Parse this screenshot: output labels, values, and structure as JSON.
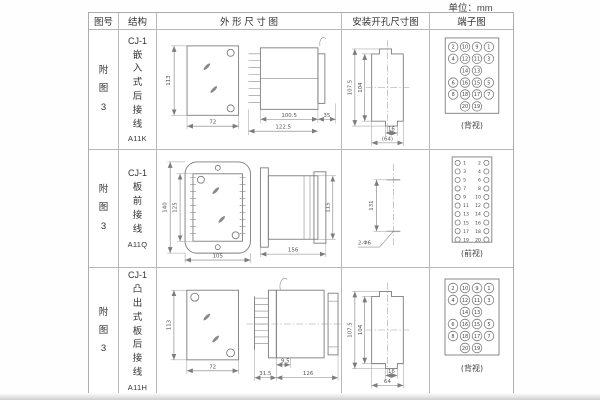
{
  "page": {
    "unit_label": "单位：mm"
  },
  "table": {
    "headers": {
      "fig_no": "图号",
      "structure": "结构",
      "outline": "外 形 尺 寸 图",
      "mounting": "安装开孔尺寸图",
      "terminal": "端子图"
    }
  },
  "rows": [
    {
      "fig_no": "附图3",
      "model": "CJ-1",
      "structure": "嵌入式后接线",
      "code": "A11K",
      "outline": {
        "h": "113",
        "w": "72",
        "d1": "100.5",
        "d2": "122.5",
        "d3": "35"
      },
      "mounting": {
        "outer_h": "107.5",
        "inner_h": "104",
        "slot_w": "16",
        "outer_w": "(64)"
      },
      "terminal": {
        "view": "(背视)",
        "grid": [
          [
            "2",
            "10",
            "9",
            "1"
          ],
          [
            "4",
            "12",
            "11",
            "3"
          ],
          [
            null,
            "14",
            "13",
            null
          ],
          [
            "6",
            "16",
            "15",
            "5"
          ],
          [
            "8",
            "18",
            "17",
            "7"
          ],
          [
            null,
            "20",
            "19",
            null
          ]
        ]
      }
    },
    {
      "fig_no": "附图3",
      "model": "CJ-1",
      "structure": "板前接线",
      "code": "A11Q",
      "outline": {
        "outer_h": "140",
        "inner_h": "125",
        "w": "105",
        "d": "156",
        "side_h": "115"
      },
      "mounting": {
        "spacing": "131",
        "holes": "2-Φ6"
      },
      "terminal": {
        "view": "(前视)",
        "left": [
          "1",
          "3",
          "5",
          "7",
          "9",
          "11",
          "13",
          "15",
          "17",
          "19"
        ],
        "right": [
          "2",
          "4",
          "6",
          "8",
          "10",
          "12",
          "14",
          "16",
          "18",
          "20"
        ]
      }
    },
    {
      "fig_no": "附图3",
      "model": "CJ-1",
      "structure": "凸出式板后接线",
      "code": "A11H",
      "outline": {
        "h": "113",
        "w": "72",
        "comb_d": "31.5",
        "pin_d": "9.5",
        "d": "126"
      },
      "mounting": {
        "outer_h": "107.5",
        "inner_h": "104",
        "slot_w": "16",
        "outer_w": "64"
      },
      "terminal": {
        "view": "(背视)",
        "grid": [
          [
            "2",
            "10",
            "9",
            "1"
          ],
          [
            "4",
            "12",
            "11",
            "3"
          ],
          [
            null,
            "14",
            "13",
            null
          ],
          [
            "6",
            "16",
            "15",
            "5"
          ],
          [
            "8",
            "18",
            "17",
            "7"
          ],
          [
            null,
            "20",
            "19",
            null
          ]
        ]
      }
    }
  ]
}
